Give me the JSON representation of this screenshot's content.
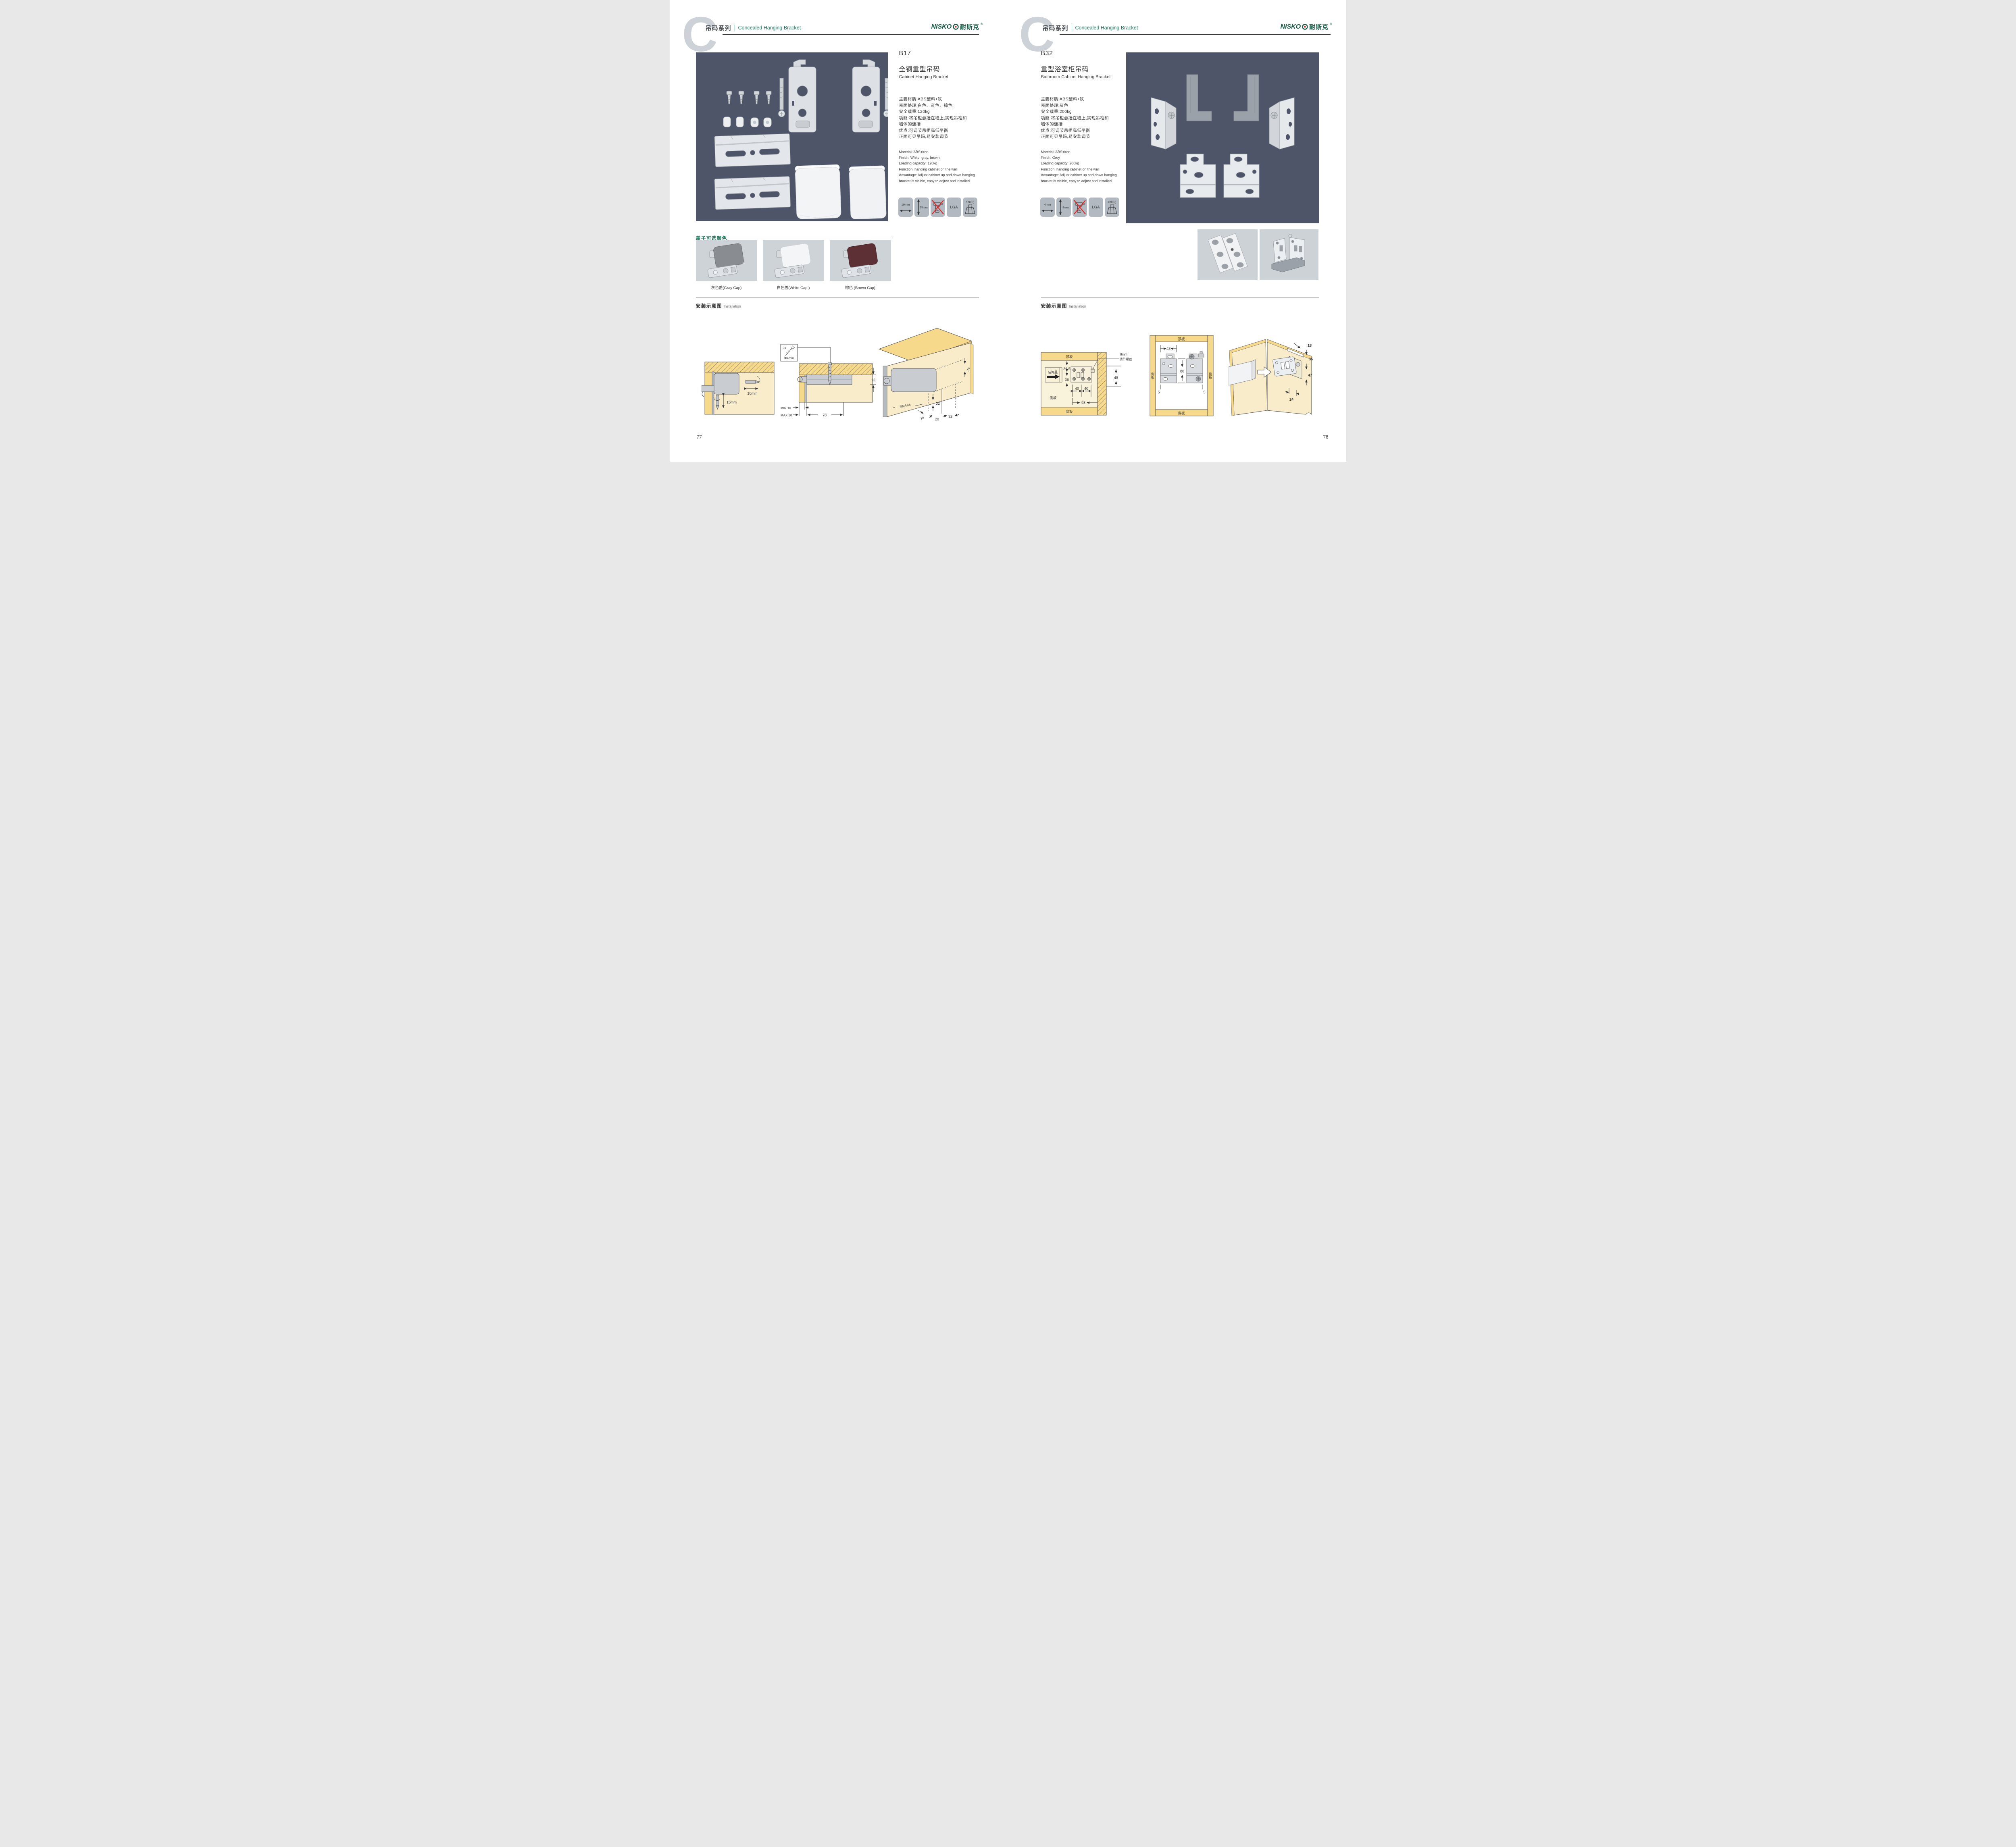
{
  "brand": {
    "logo_latin": "NISKO",
    "logo_cn": "耐斯克",
    "reg": "®"
  },
  "header": {
    "series": "吊码系列",
    "subtitle": "Concealed Hanging Bracket"
  },
  "left_page": {
    "page_number": "77",
    "product": {
      "code": "B17",
      "name_cn": "全钢重型吊码",
      "name_en": "Cabinet Hanging Bracket",
      "specs_cn": [
        "主要材质:ABS塑料+铁",
        "表面处理:白色、灰色、棕色",
        "安全载重:120kg",
        "功能:将吊柜悬挂在墙上,实现吊柜和",
        "墙体的连接",
        "优点:可调节吊柜高低平衡",
        "正面可见吊码,易安装调节"
      ],
      "specs_en": [
        "Material: ABS+iron",
        "Finish: White, gray, brown",
        "Loading capacity: 120kg",
        "Function: hanging cabinet on the wall",
        "Advantage: Adjust cabinet up and down hanging",
        "bracket is visible, easy to adjust and installed"
      ],
      "icons": {
        "width": "10mm",
        "height": "15mm",
        "cert": "LGA",
        "load": "120Kg"
      }
    },
    "caps": {
      "title": "盖子可选颜色",
      "items": [
        {
          "label": "灰色盖(Gray Cap)",
          "color": "#898d91"
        },
        {
          "label": "白色盖(White Cap )",
          "color": "#f4f5f6"
        },
        {
          "label": "棕色 (Brown Cap)",
          "color": "#5c3034"
        }
      ]
    },
    "installation": {
      "title": "安装示意图",
      "subtitle": "Installation",
      "d1": {
        "width": "10mm",
        "height": "15mm"
      },
      "d2": {
        "qty": "2x",
        "screw": "Φ4mm",
        "thickness": "13",
        "min": "MIN.10",
        "max": "MAX.30",
        "span": "78"
      },
      "d3": {
        "a": "34",
        "b": "32",
        "r": "RMAX4",
        "c": "18",
        "d": "20",
        "e": "32"
      }
    }
  },
  "right_page": {
    "page_number": "78",
    "product": {
      "code": "B32",
      "name_cn": "重型浴室柜吊码",
      "name_en": "Bathroom Cabinet Hanging Bracket",
      "specs_cn": [
        "主要材质:ABS塑料+铁",
        "表面处理:灰色",
        "安全载重:200kg",
        "功能:将吊柜悬挂在墙上,实现吊柜和",
        "墙体的连接",
        "优点:可调节吊柜高低平衡",
        "正面可见吊码,易安装调节"
      ],
      "specs_en": [
        "Material: ABS+iron",
        "Finish: Grey",
        "Loading capacity: 200kg",
        "Function: hanging cabinet on the wall",
        "Advantage: Adjust cabinet up and down hanging",
        "bracket is visible, easy to adjust and installed"
      ],
      "icons": {
        "width": "4mm",
        "height": "8mm",
        "cert": "LGA",
        "load": "200Kg"
      }
    },
    "installation": {
      "title": "安装示意图",
      "subtitle": "Installation",
      "d1": {
        "top": "顶板",
        "cover": "装饰盖",
        "side": "侧板",
        "bottom": "底板",
        "a": "36.5",
        "b": "36",
        "c": "40",
        "d": "40",
        "e": "98",
        "f": "48",
        "note1": "8mm",
        "note2": "调节螺丝"
      },
      "d2": {
        "top": "顶板",
        "bottom": "底板",
        "side_l": "侧板",
        "side_r": "侧板",
        "a": "48",
        "b": "80",
        "c": "5",
        "d": "5"
      },
      "d3": {
        "a": "18",
        "b": "35",
        "c": "47",
        "d": "24"
      }
    }
  },
  "colors": {
    "accent_green": "#1c6e55",
    "panel_dark": "#4e5568",
    "panel_light": "#ccd2d6",
    "wood": "#f6d98b",
    "wood_pale": "#f8ecca"
  }
}
